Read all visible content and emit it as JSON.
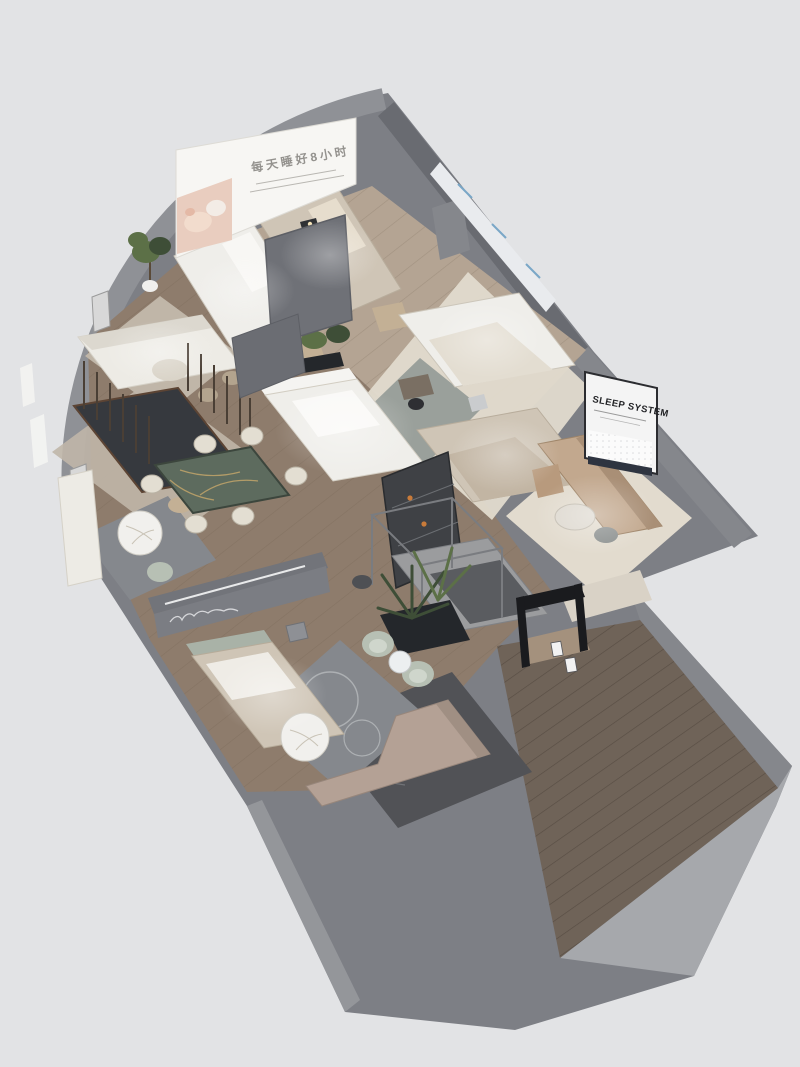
{
  "signs": {
    "banner_headline": "每天睡好8小时",
    "sleep_system_title": "SLEEP SYSTEM"
  },
  "palette": {
    "bg": "#e2e3e5",
    "wallTop": "#7d7f85",
    "wallFaceDark": "#696b71",
    "wallFaceMid": "#85878c",
    "wallFaceLight": "#a6a8ac",
    "wallCurve": "#8f9196",
    "wallInnerBL": "#94969a",
    "woodLight": "#b4a493",
    "woodMid": "#8e7c6c",
    "woodDark": "#6f6358",
    "marbleDark": "#515256",
    "marbleVein": "#8d8e92",
    "rugCream": "#e2dbce",
    "rugGray": "#9aa09b",
    "rugBeige": "#c0b6a8",
    "rugMarble": "#85888d",
    "rugCircle": "#b7babd",
    "bedWhite": "#efeeea",
    "bedBeige": "#cfc5b6",
    "bedDark": "#36393e",
    "headboardSage": "#a9b2a7",
    "benchTan": "#c3b095",
    "sofaWhite": "#edebe5",
    "sofaTan": "#c2a88e",
    "sofaTanDark": "#a98f76",
    "sofaTaupe": "#b4a195",
    "sage": "#b7c0b4",
    "sageLight": "#cfd6cc",
    "tableWhite": "#f1f0ed",
    "marbleGreen": "#5d6b5e",
    "goldVein": "#c9a96a",
    "plantDark": "#3e4e37",
    "plantMid": "#5c7047",
    "planter": "#24272b",
    "metal": "#7a7c80",
    "black": "#1a1b1e",
    "white": "#f6f6f5",
    "posterWhite": "#e9ebee",
    "posterBlue": "#7aa7c7",
    "bannerWhite": "#f7f6f3",
    "babySkin": "#e9cdbf",
    "babyBlanket": "#f3ece6",
    "signDark": "#2b2c30",
    "textGray": "#94928e",
    "mattressBase": "#2e3440",
    "cabinetDark": "#3f4145",
    "amber": "#c97b3a",
    "lampWarm": "#f3e2b8"
  }
}
